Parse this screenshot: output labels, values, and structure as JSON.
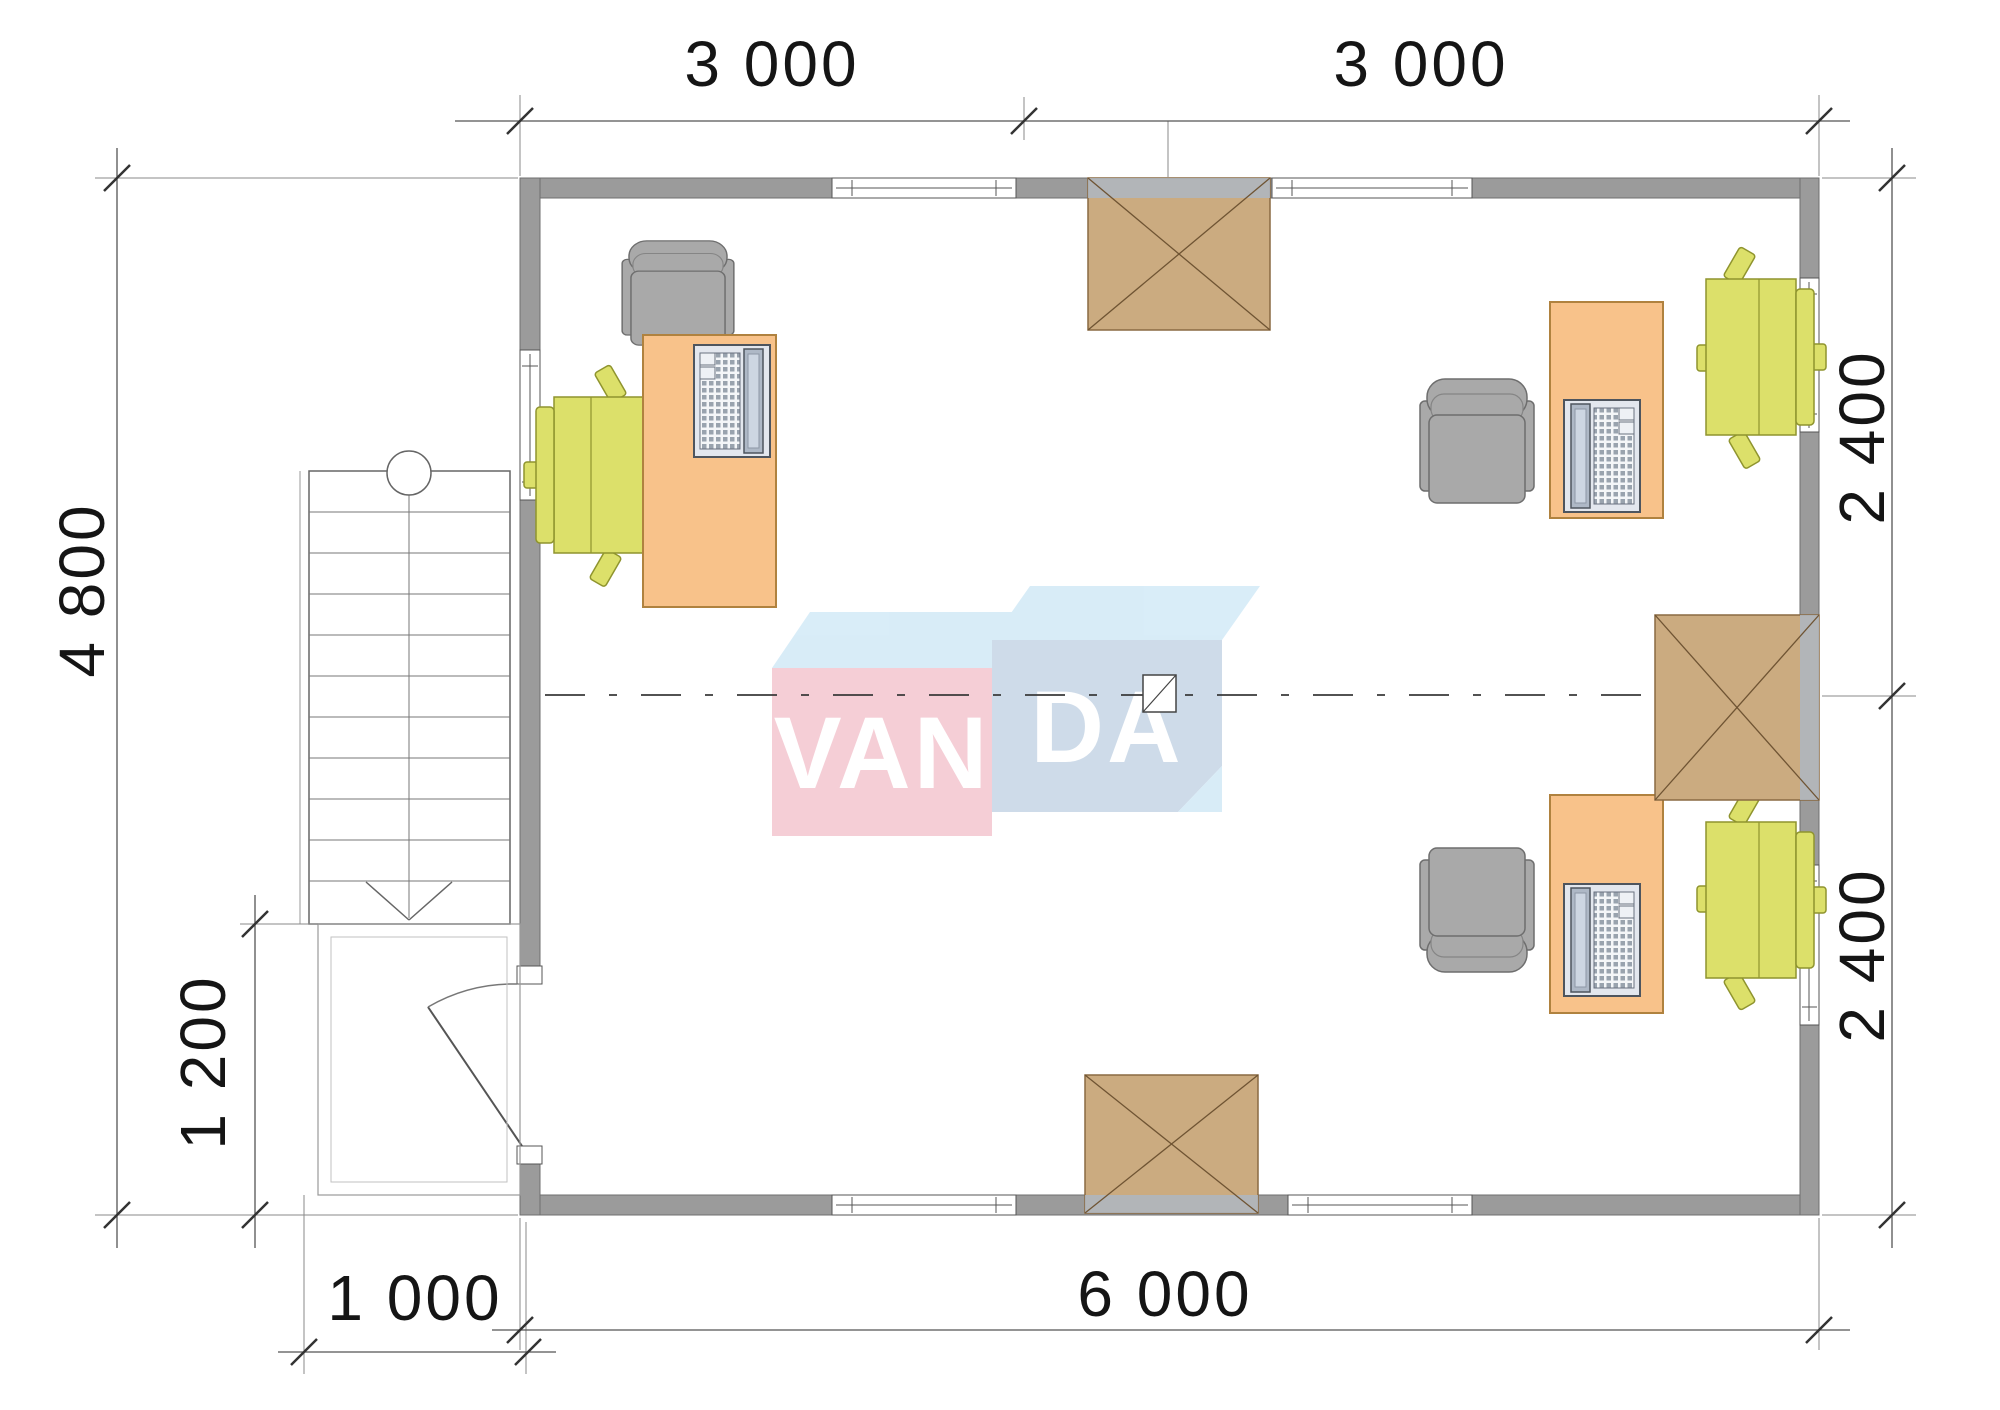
{
  "drawing": {
    "type": "floor-plan",
    "background": "#ffffff"
  },
  "dimensions": {
    "top": [
      "3 000",
      "3 000"
    ],
    "right": [
      "2 400",
      "2 400"
    ],
    "left": [
      "4 800",
      "1 200"
    ],
    "bottom": [
      "6 000",
      "1 000"
    ]
  },
  "logo": {
    "left_text": "VAN",
    "right_text": "DA",
    "pink_face": "#f3c2cd",
    "blue_face": "#c2d3e4",
    "top_face": "#cfe8f6",
    "text_color": "#ffffff"
  },
  "colors": {
    "wall": "#9b9b9b",
    "wall_outline": "#6f6f6f",
    "desk": "#f8c28a",
    "desk_border": "#b0823f",
    "chair_gray": "#a9a9a9",
    "chair_gray_border": "#6e6e6e",
    "chair_green": "#dce06a",
    "chair_green_border": "#8f942e",
    "box_brown": "#cbab80",
    "box_brown_border": "#8a6a42",
    "box_overlap": "#aeb6c2",
    "dim_line": "#555555",
    "tick": "#333333",
    "text": "#151515"
  },
  "furniture": {
    "desks": [
      "desk-left",
      "desk-upper-right",
      "desk-lower-right"
    ],
    "gray_armchairs": 3,
    "green_task_chairs": 3,
    "laptops": 3,
    "crossed_hatch_boxes": [
      "top",
      "right",
      "bottom"
    ],
    "stairs": "left-stairs-down-arrow",
    "door": "left-wall-swing-door"
  }
}
